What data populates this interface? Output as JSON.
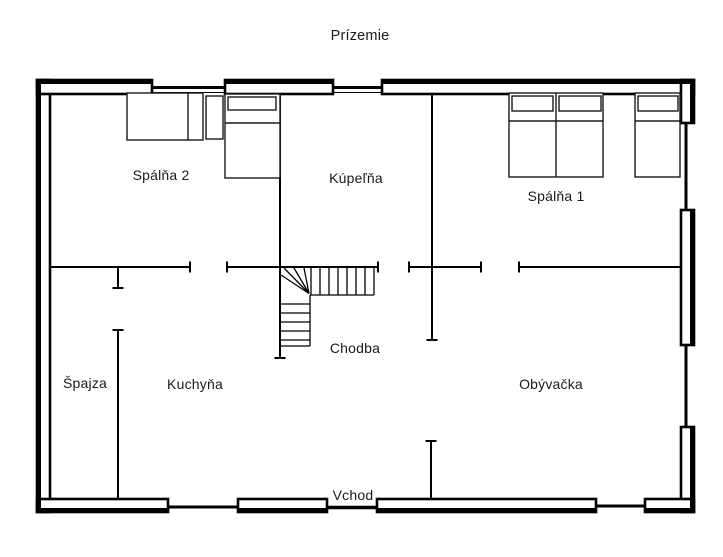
{
  "title": "Prízemie",
  "rooms": {
    "spalna2": "Spálňa 2",
    "kupelna": "Kúpeľňa",
    "spalna1": "Spálňa 1",
    "spajza": "Špajza",
    "kuchyna": "Kuchyňa",
    "chodba": "Chodba",
    "obyvacka": "Obývačka"
  },
  "entrance": "Vchod",
  "colors": {
    "background": "#ffffff",
    "wall_line": "#000000",
    "text": "#1a1a1a"
  }
}
